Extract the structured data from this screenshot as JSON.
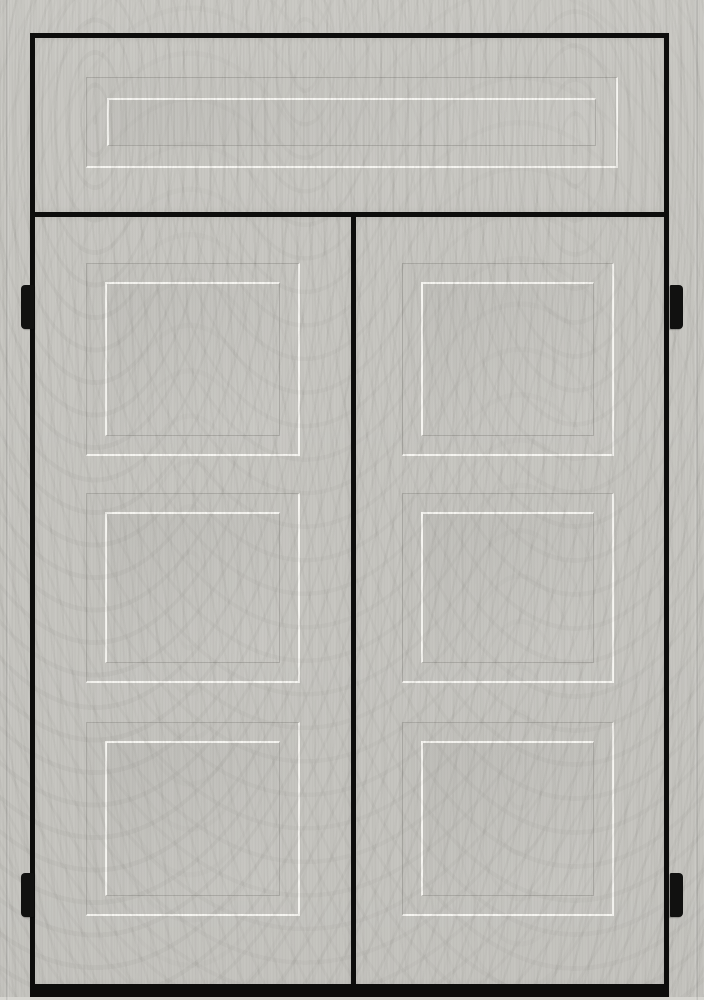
{
  "meta": {
    "description": "Light grey painted double door with woodgrain texture: transom panel above, two door leaves each with three recessed square panels, black perimeter frame, black center and transom dividers, black bottom kick bar, and two black hinges on each side"
  },
  "colors": {
    "base": "#c8c7c2",
    "highlight_line": "#f6f5f1",
    "groove_line": "#aaa9a4",
    "frame_black": "#0d0d0c",
    "hinge_black": "#111110",
    "floor_light": "#d7d6d1"
  },
  "scene": {
    "parts": {
      "transom": "transom-panel",
      "left_door": "left-door-leaf",
      "right_door": "right-door-leaf"
    },
    "panels_per_leaf": 3,
    "transom_panels": 1,
    "hinge_count": 4,
    "hardware": "no handles or knobs visible"
  }
}
